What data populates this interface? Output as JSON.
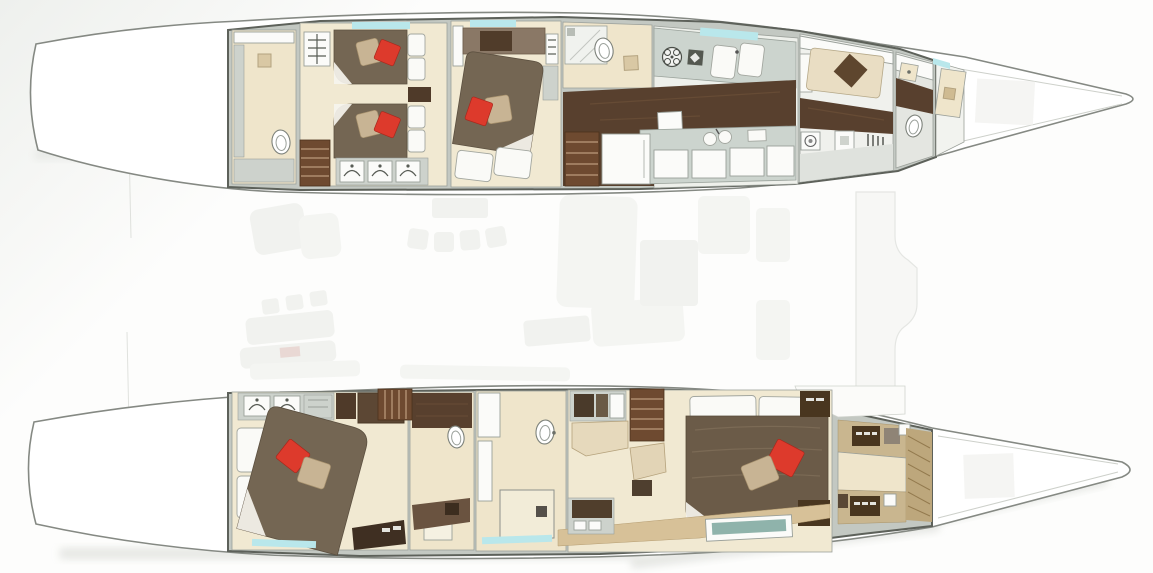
{
  "colors": {
    "bg": "#fdfdfc",
    "hull-outline": "#858983",
    "wall": "#c3c8c2",
    "wall-dark": "#5d615a",
    "floor-cream": "#f1e9d2",
    "floor-cream-2": "#efe5cb",
    "wood-dark": "#58402e",
    "wood-streak": "#6d5138",
    "stair-brown": "#6e4a30",
    "duvet-brown": "#746653",
    "duvet-master": "#6b5b48",
    "headboard-dark": "#503c2a",
    "pillow-red": "#dd3a2c",
    "pillow-tan": "#c8b494",
    "pillow-white": "#fafaf7",
    "counter": "#ccd4ce",
    "white-furniture": "#fbfbf9",
    "window-cyan": "#b9e7eb",
    "tan-band": "#d7c198",
    "tan-hatch": "#bda77c",
    "crew-mattress": "#e9ddc3",
    "crew-pillow": "#5e462e",
    "teal-cushion": "#8fb3ab",
    "ghost": "#eaece7",
    "ghost-pink": "#dcc0ba",
    "closet-base": "#c9b68f",
    "closet-dark": "#49361f",
    "shadow": "#cfd2cc"
  },
  "plan": {
    "type": "catamaran-lower-deck-floor-plan",
    "orientation": "bow-right",
    "port_hull": {
      "position": "top",
      "rooms": [
        {
          "name": "aft-bathroom",
          "fixtures": [
            "shower",
            "vanity",
            "toilet"
          ]
        },
        {
          "name": "twin-guest-cabin",
          "fixtures": [
            "single-bed",
            "single-bed",
            "nightstand",
            "wardrobe",
            "companionway-stairs",
            "ladder"
          ]
        },
        {
          "name": "vip-guest-cabin",
          "fixtures": [
            "double-bed",
            "headboard-cabinet",
            "wardrobe",
            "ladder"
          ]
        },
        {
          "name": "guest-bathroom",
          "fixtures": [
            "shower",
            "toilet",
            "bidet"
          ]
        },
        {
          "name": "galley",
          "fixtures": [
            "cooktop",
            "oven",
            "double-sink",
            "round-sinks",
            "cabinets",
            "companionway-stairs"
          ]
        },
        {
          "name": "crew-cabin",
          "fixtures": [
            "berth",
            "washer",
            "locker"
          ]
        },
        {
          "name": "fore-head",
          "fixtures": [
            "sink",
            "toilet"
          ]
        },
        {
          "name": "forepeak-locker",
          "fixtures": [
            "locker"
          ]
        }
      ]
    },
    "starboard_hull": {
      "position": "bottom",
      "rooms": [
        {
          "name": "aft-guest-cabin",
          "fixtures": [
            "double-bed",
            "wardrobe",
            "steps",
            "tv-cabinet"
          ]
        },
        {
          "name": "guest-bathroom",
          "fixtures": [
            "toilet",
            "vanity",
            "companionway-stairs",
            "shower"
          ]
        },
        {
          "name": "master-bathroom",
          "fixtures": [
            "vanity",
            "toilet",
            "shower"
          ]
        },
        {
          "name": "master-cabin",
          "fixtures": [
            "double-bed",
            "desk",
            "chaise",
            "companionway-stairs",
            "bench-seat",
            "side-cabinets",
            "vanity"
          ]
        },
        {
          "name": "walk-in-wardrobe",
          "fixtures": [
            "cabinets",
            "drawers",
            "angled-bulkhead"
          ]
        }
      ]
    },
    "bridge_deck": {
      "style": "ghosted",
      "items": [
        "cockpit-seats",
        "cockpit-stools",
        "cockpit-table",
        "cockpit-bench",
        "dining-table",
        "dining-chairs",
        "saloon-sofa",
        "galley-island",
        "nav-station",
        "foredeck-beam"
      ]
    },
    "bed_count": 6,
    "red_pillow_count": 5
  }
}
